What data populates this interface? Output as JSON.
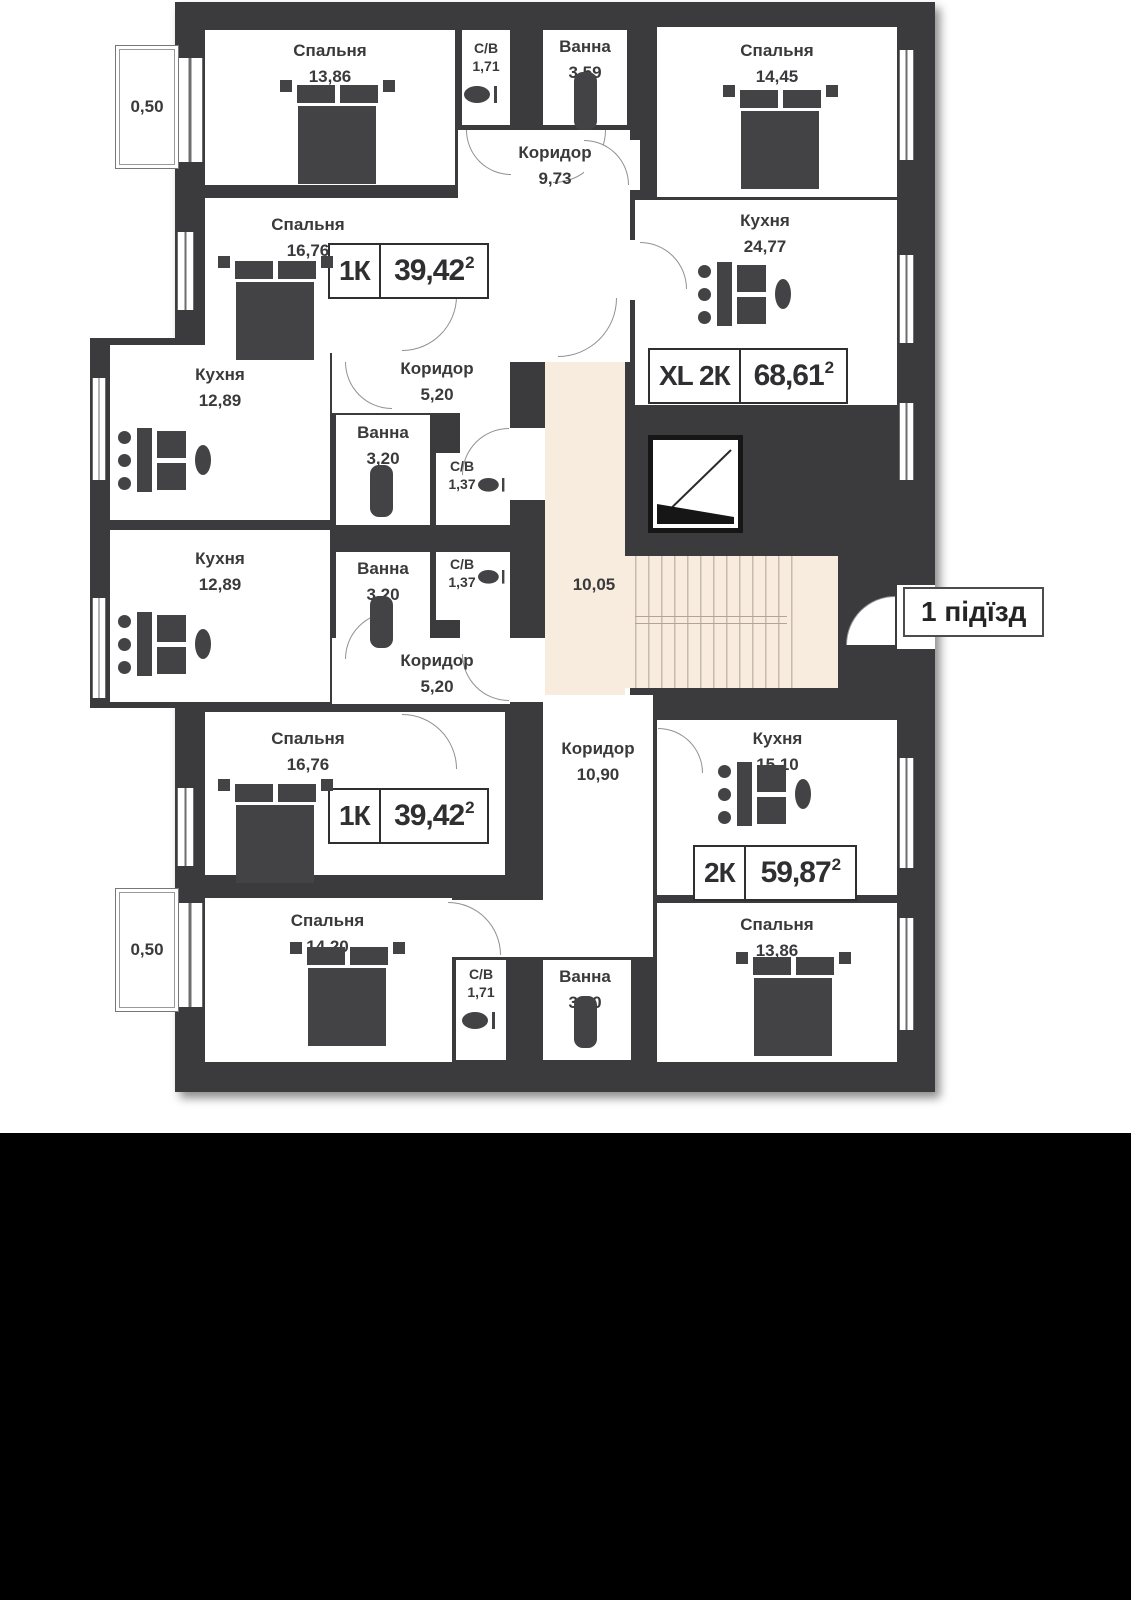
{
  "plan": {
    "entrance": {
      "label": "1 підїзд"
    },
    "stairwell": {
      "area": "10,05"
    },
    "balcony_top": {
      "area": "0,50"
    },
    "balcony_bottom": {
      "area": "0,50"
    },
    "rooms": {
      "bedroom_tl": {
        "name": "Спальня",
        "area": "13,86"
      },
      "wc_top": {
        "name": "С/В",
        "area": "1,71"
      },
      "bath_top": {
        "name": "Ванна",
        "area": "3,59"
      },
      "corridor_top": {
        "name": "Коридор",
        "area": "9,73"
      },
      "bedroom_tr": {
        "name": "Спальня",
        "area": "14,45"
      },
      "bedroom_16_top": {
        "name": "Спальня",
        "area": "16,76"
      },
      "kitchen_xl": {
        "name": "Кухня",
        "area": "24,77"
      },
      "kitchen_left_top": {
        "name": "Кухня",
        "area": "12,89"
      },
      "corridor_unit_top": {
        "name": "Коридор",
        "area": "5,20"
      },
      "bath_unit_top": {
        "name": "Ванна",
        "area": "3,20"
      },
      "wc_unit_top": {
        "name": "С/В",
        "area": "1,37"
      },
      "kitchen_left_bot": {
        "name": "Кухня",
        "area": "12,89"
      },
      "bath_unit_bot": {
        "name": "Ванна",
        "area": "3,20"
      },
      "wc_unit_bot": {
        "name": "С/В",
        "area": "1,37"
      },
      "corridor_unit_bot": {
        "name": "Коридор",
        "area": "5,20"
      },
      "bedroom_16_bot": {
        "name": "Спальня",
        "area": "16,76"
      },
      "corridor_2k": {
        "name": "Коридор",
        "area": "10,90"
      },
      "kitchen_2k": {
        "name": "Кухня",
        "area": "15,10"
      },
      "bedroom_bl": {
        "name": "Спальня",
        "area": "14,20"
      },
      "wc_bottom": {
        "name": "С/В",
        "area": "1,71"
      },
      "bath_bottom": {
        "name": "Ванна",
        "area": "3,60"
      },
      "bedroom_br": {
        "name": "Спальня",
        "area": "13,86"
      }
    },
    "units": {
      "unit_1k_top": {
        "type": "1К",
        "area": "39,42",
        "sup": "2"
      },
      "unit_xl2k": {
        "type": "XL 2К",
        "area": "68,61",
        "sup": "2"
      },
      "unit_1k_bottom": {
        "type": "1К",
        "area": "39,42",
        "sup": "2"
      },
      "unit_2k": {
        "type": "2К",
        "area": "59,87",
        "sup": "2"
      }
    }
  },
  "colors": {
    "wall": "#3b3b3d",
    "stair_fill": "#f8ecdf",
    "text": "#3a3a3c",
    "furniture": "#434345"
  }
}
